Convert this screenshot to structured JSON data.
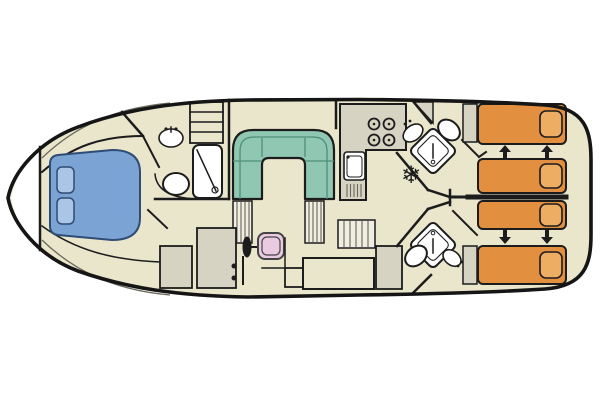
{
  "diagram": {
    "kind": "boat-floor-plan",
    "orientation": "bow-left-stern-right",
    "berths": {
      "bow_double_beds": 1,
      "stern_single_beds": 4
    }
  },
  "colors": {
    "floor": "#EAE6CC",
    "deck": "#FFFFFF",
    "counter": "#D6D3C3",
    "sofa": "#8FC7B2",
    "bed_blue": "#7BA4D5",
    "pillow_blue": "#A9C6E6",
    "bed_orange": "#E2903F",
    "pillow_orange": "#EDAD62",
    "seat_pink": "#EACADF",
    "fixture": "#FFFFFF",
    "step_fill": "#F0EEE3",
    "wall": "#1C1C1C"
  },
  "icons": {
    "fridge_snowflake": "❄",
    "slide_arrow_up": "▲",
    "slide_arrow_down": "▼"
  },
  "rooms": {
    "bow_cabin": {
      "furniture": [
        "double-bed",
        "two-pillows",
        "washbasin",
        "wardrobe-shelves"
      ]
    },
    "bow_bathroom": {
      "furniture": [
        "shower-stall",
        "toilet",
        "vanity-counter"
      ]
    },
    "salon": {
      "furniture": [
        "u-shaped-sofa",
        "steering-wheel",
        "helm-seat",
        "side-steps",
        "aft-steps",
        "bench",
        "cabinets"
      ]
    },
    "galley": {
      "furniture": [
        "four-burner-stove",
        "sink-with-drainboard",
        "refrigerator"
      ]
    },
    "aft_bathroom_port": {
      "furniture": [
        "corner-shower",
        "washbasin",
        "toilet"
      ]
    },
    "aft_bathroom_starboard": {
      "furniture": [
        "corner-shower",
        "washbasin",
        "toilet"
      ]
    },
    "aft_cabin_port": {
      "furniture": [
        "single-bed",
        "single-bed",
        "slide-together-arrows"
      ]
    },
    "aft_cabin_starboard": {
      "furniture": [
        "single-bed",
        "single-bed",
        "slide-together-arrows"
      ]
    }
  }
}
